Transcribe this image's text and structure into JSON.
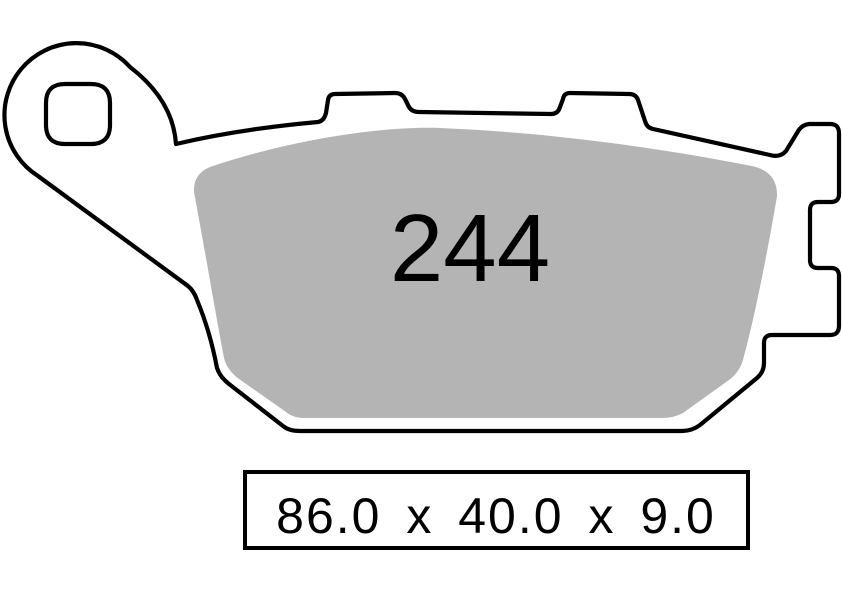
{
  "page": {
    "background": "#ffffff"
  },
  "diagram": {
    "type": "brake-pad-profile-drawing",
    "part_number": "244",
    "dimensions_text": "86.0 x 40.0 x 9.0",
    "dimensions": {
      "length_mm": "86.0",
      "width_mm": "40.0",
      "thickness_mm": "9.0",
      "separator": "x"
    },
    "colors": {
      "outline": "#000000",
      "backing_plate": "#ffffff",
      "friction_material": "#b4b4b4",
      "text": "#000000"
    }
  }
}
